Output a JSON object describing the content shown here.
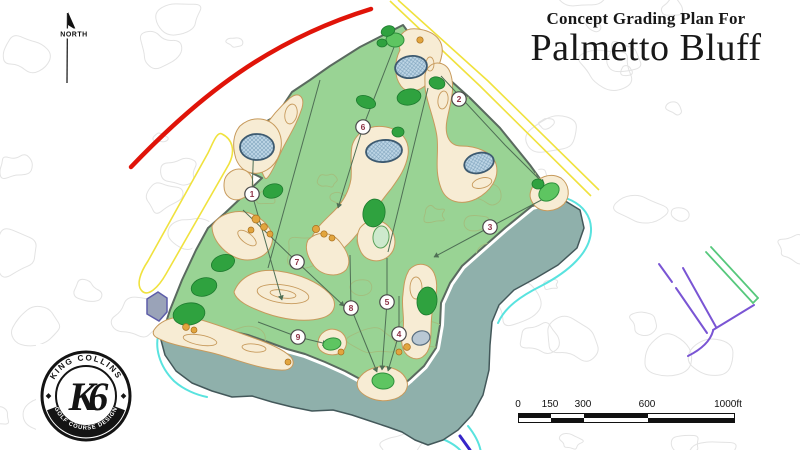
{
  "title": {
    "line1": "Concept Grading Plan For",
    "line2": "Palmetto Bluff"
  },
  "north_label": "NORTH",
  "logo": {
    "arc_top": "KING COLLINS",
    "arc_bottom": "GOLF COURSE DESIGN",
    "monogram": "K6"
  },
  "scale_bar": {
    "unit": "ft",
    "labels": [
      "0",
      "150",
      "300",
      "600",
      "1000ft"
    ],
    "values": [
      0,
      150,
      300,
      600,
      1000
    ]
  },
  "map": {
    "type": "golf-course-concept-grading-plan",
    "holes": [
      {
        "number": "1",
        "x": 252,
        "y": 194
      },
      {
        "number": "2",
        "x": 459,
        "y": 99
      },
      {
        "number": "3",
        "x": 490,
        "y": 227
      },
      {
        "number": "4",
        "x": 399,
        "y": 334
      },
      {
        "number": "5",
        "x": 387,
        "y": 302
      },
      {
        "number": "6",
        "x": 363,
        "y": 127
      },
      {
        "number": "7",
        "x": 297,
        "y": 262
      },
      {
        "number": "8",
        "x": 351,
        "y": 308
      },
      {
        "number": "9",
        "x": 298,
        "y": 337
      }
    ],
    "colors": {
      "fairway": "#99d394",
      "boundary": "#5a6a5f",
      "sand": "#f7ecd4",
      "sand_contour": "#c79a5c",
      "pond": "#bed6e6",
      "pond_outline": "#3d5a70",
      "lagoon": "#8fb0ab",
      "lagoon_outline": "#43585a",
      "tree": "#2fa23f",
      "putting_green": "#5ec561",
      "road_red": "#e01409",
      "boundary_yellow": "#f0e23e",
      "shore_cyan": "#59e3df",
      "survey_purple": "#7a55d4",
      "survey_green": "#57c87d",
      "survey_blue": "#3626c8",
      "contour_gray": "#e3e3e3",
      "course_contour": "#a3bd7d",
      "bush_orange": "#e2a53e",
      "marker_number": "#8e3346",
      "clubhouse_gray": "#9aa3b8"
    }
  }
}
